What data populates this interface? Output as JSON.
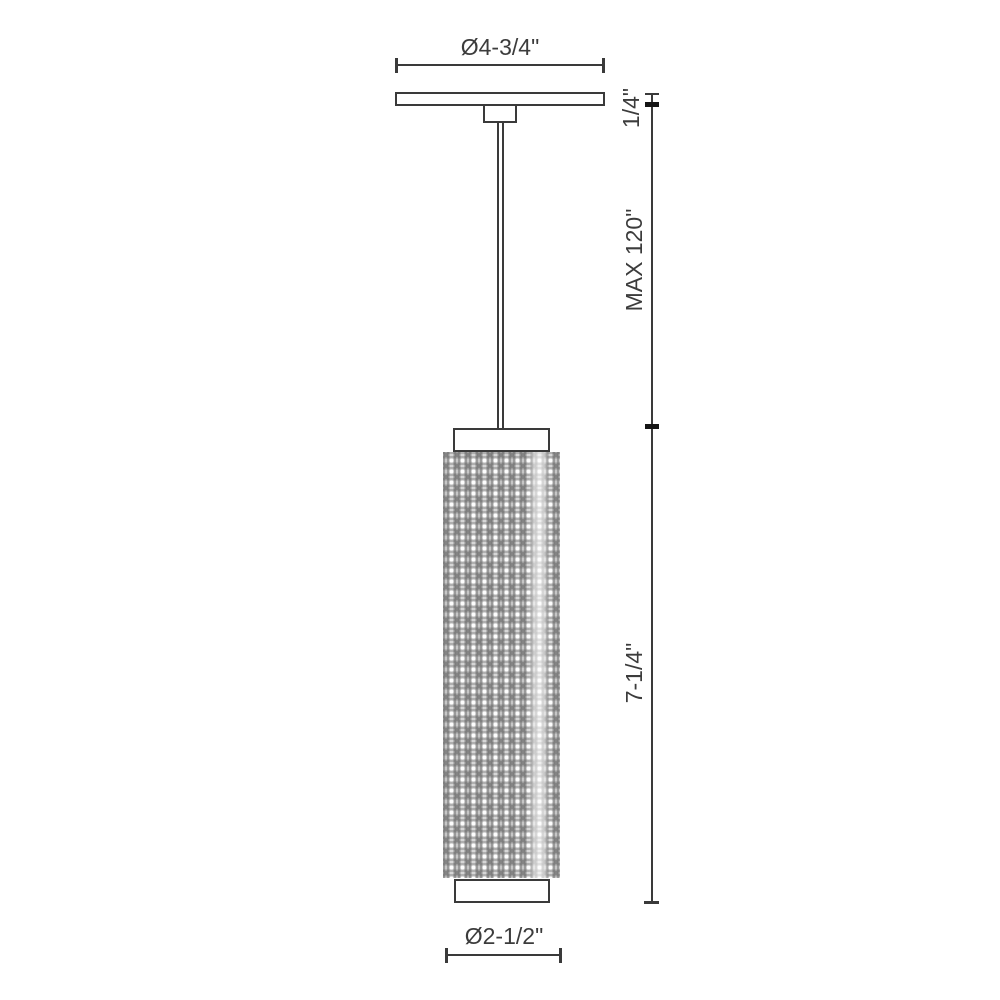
{
  "diagram": {
    "labels": {
      "canopy_diameter": "Ø4-3/4\"",
      "canopy_height": "1/4\"",
      "max_suspension": "MAX 120\"",
      "fixture_height": "7-1/4\"",
      "shade_diameter": "Ø2-1/2\""
    },
    "colors": {
      "line": "#3a3a3a",
      "tick": "#151515",
      "text": "#3c3c3c",
      "background": "#ffffff",
      "shade_base": "#dcdcdc",
      "shade_stripe": "#9a9a9a"
    }
  }
}
